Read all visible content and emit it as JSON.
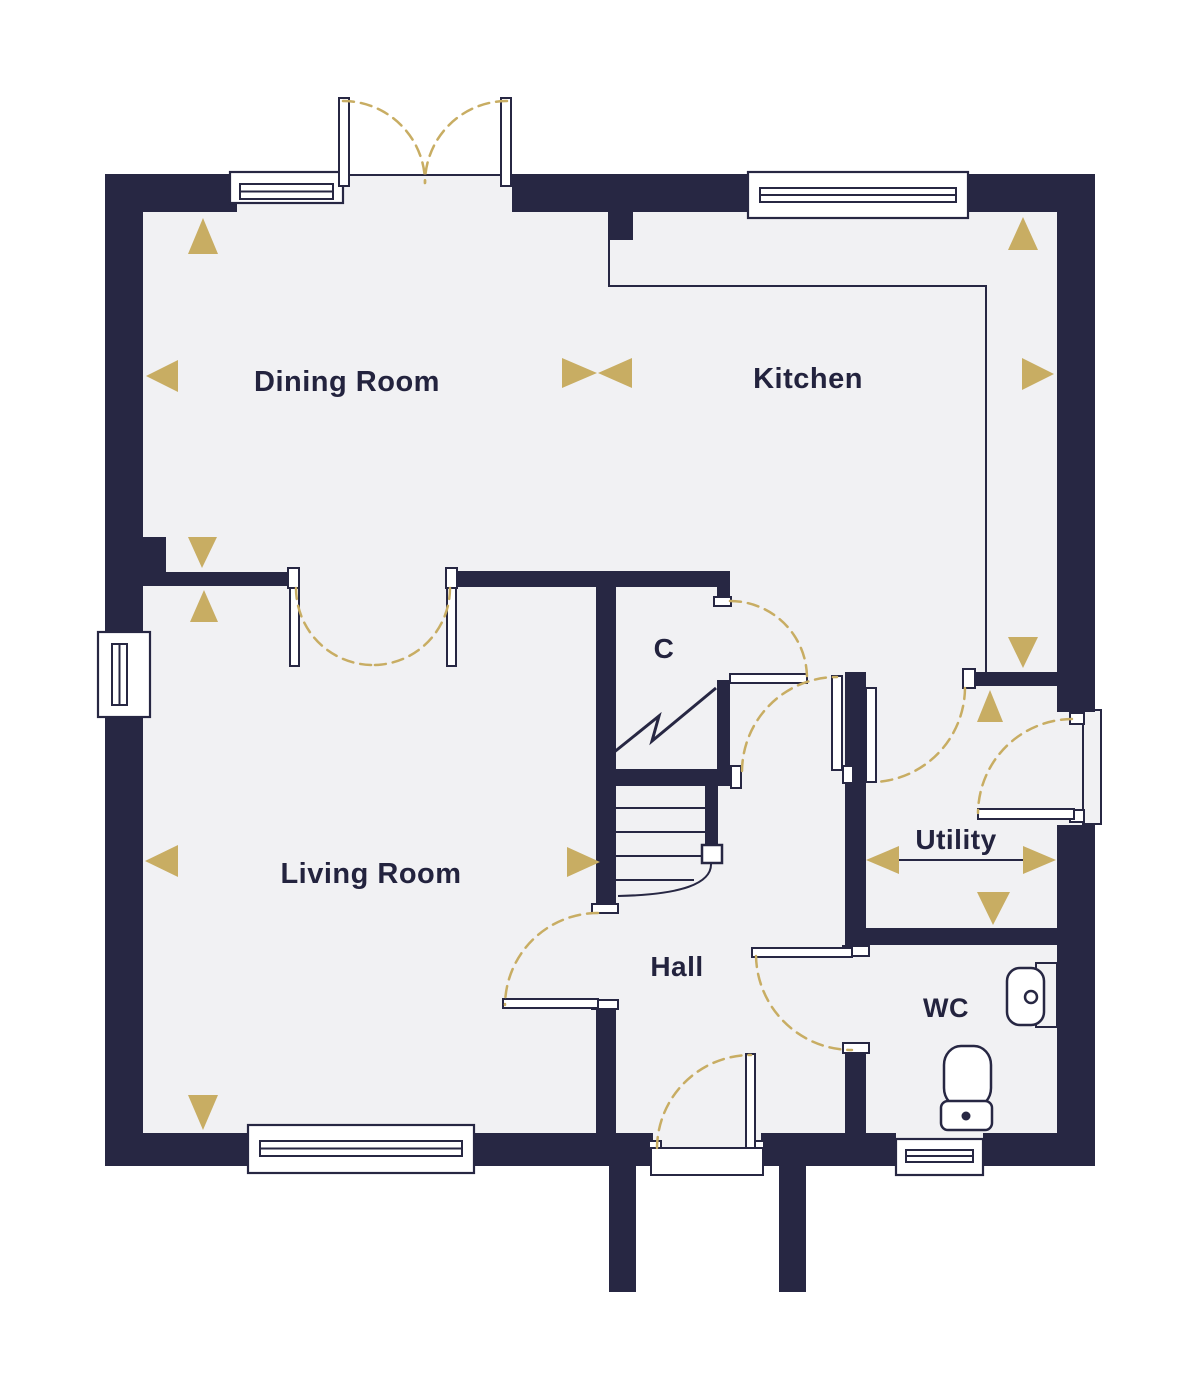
{
  "floor_plan": {
    "labels": {
      "dining_room": "Dining Room",
      "kitchen": "Kitchen",
      "living_room": "Living Room",
      "hall": "Hall",
      "cupboard": "C",
      "utility": "Utility",
      "wc": "WC"
    },
    "colors": {
      "wall": "#272743",
      "text": "#23233E",
      "gold": "#C8AD63",
      "floor": "#F1F1F3",
      "background": "#FFFFFF"
    },
    "symbols": {
      "windows": [
        "dining-room-window",
        "kitchen-window",
        "living-room-side-window",
        "living-room-front-window",
        "wc-window"
      ],
      "doors": [
        "patio-double-doors",
        "dining-living-double-doors",
        "cupboard-door",
        "hall-kitchen-door",
        "kitchen-utility-door",
        "utility-external-door",
        "wc-door",
        "living-room-door",
        "front-door"
      ],
      "fixtures": [
        "staircase",
        "wc-toilet",
        "wc-basin"
      ],
      "markers": [
        "gold-direction-triangles",
        "utility-dimension-arrow"
      ]
    }
  }
}
